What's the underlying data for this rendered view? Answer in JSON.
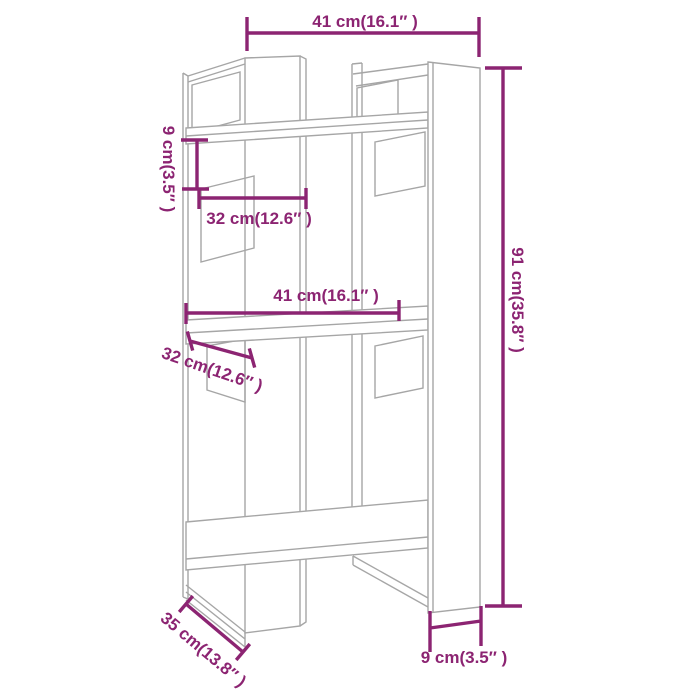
{
  "figure": {
    "type": "product-dimension-diagram",
    "subject": "book cabinet / room divider wireframe drawing",
    "background_color": "#ffffff",
    "wireframe_color": "#a6a6a6",
    "dimension_color": "#8c2472"
  },
  "dimensions": {
    "top_width": "41 cm(16.1″ )",
    "upper_left_height": "9 cm(3.5″ )",
    "upper_left_depth": "32 cm(12.6″ )",
    "middle_width": "41 cm(16.1″ )",
    "middle_left_depth": "32 cm(12.6″ )",
    "right_height": "91 cm(35.8″ )",
    "bottom_left_depth": "35 cm(13.8″ )",
    "bottom_right_width": "9 cm(3.5″ )"
  }
}
